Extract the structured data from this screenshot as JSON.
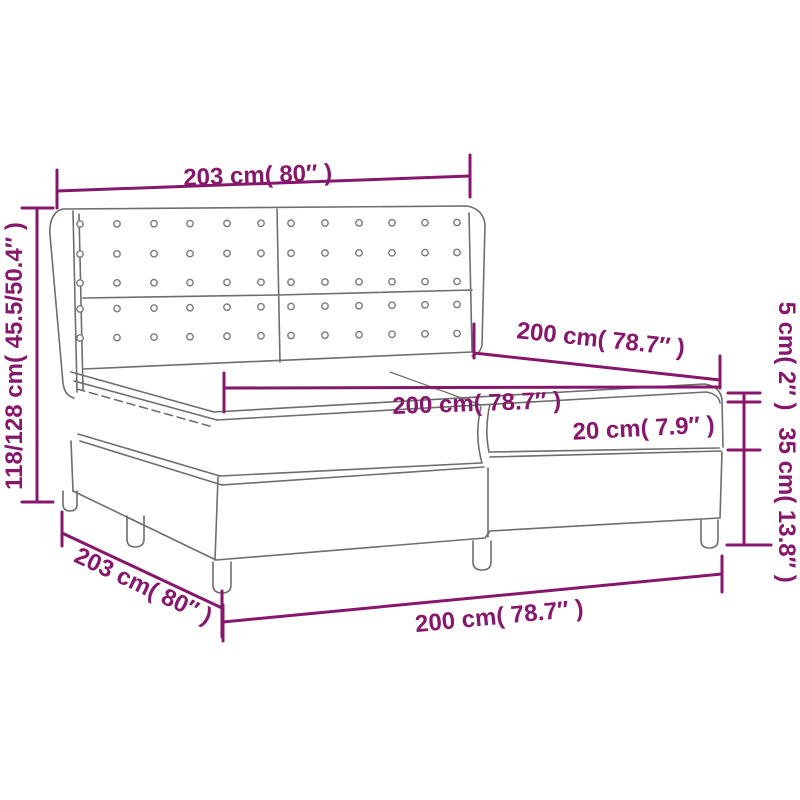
{
  "figure": {
    "type": "product dimension diagram",
    "subject": "box spring bed with tufted wing headboard, mattress and topper"
  },
  "colors": {
    "dimension_accent": "#87176C",
    "drawing_line": "#6e6e6e",
    "background": "#ffffff"
  },
  "dimensions": {
    "headboard_width": {
      "label": "203 cm( 80″ )"
    },
    "headboard_height": {
      "label": "118/128 cm( 45.5/50.4″ )"
    },
    "mattress_length": {
      "label": "200 cm( 78.7″ )"
    },
    "mattress_width": {
      "label": "200 cm( 78.7″ )"
    },
    "mattress_thickness": {
      "label": "20 cm( 7.9″ )"
    },
    "topper_thickness": {
      "label": "5 cm( 2″ )"
    },
    "base_height": {
      "label": "35 cm( 13.8″ )"
    },
    "frame_length": {
      "label": "203 cm( 80″ )"
    },
    "frame_width": {
      "label": "200 cm( 78.7″ )"
    }
  }
}
